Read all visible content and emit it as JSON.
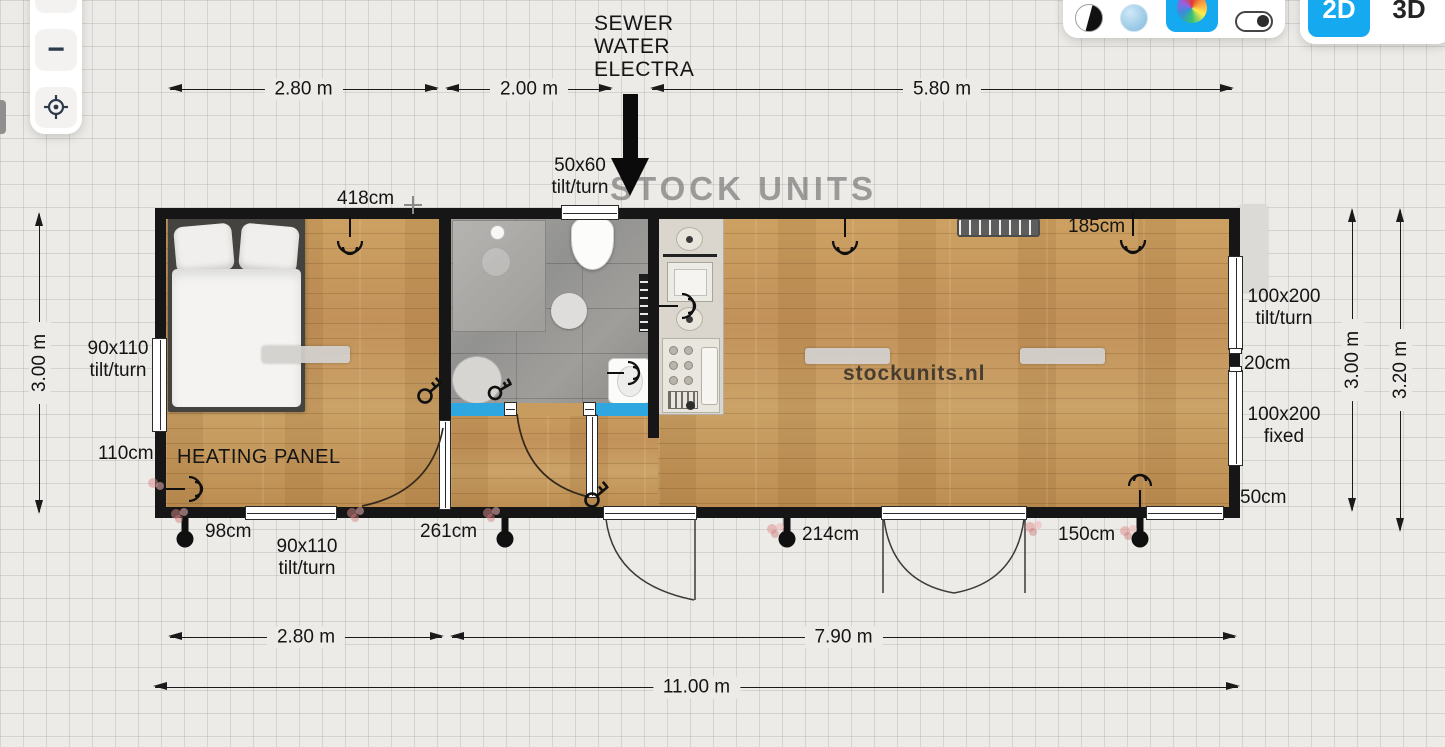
{
  "toolbar": {
    "zoom_in": "+",
    "zoom_out": "−"
  },
  "view_switch": {
    "two_d": "2D",
    "three_d": "3D"
  },
  "plan": {
    "watermark_logo": "STOCK UNITS",
    "watermark_site": "stockunits.nl",
    "heating_panel": "HEATING PANEL",
    "utility_lines": [
      "SEWER",
      "WATER",
      "ELECTRA"
    ],
    "labels": {
      "win_top": [
        "50x60",
        "tilt/turn"
      ],
      "len_418": "418cm",
      "len_185": "185cm",
      "win_right_top": [
        "100x200",
        "tilt/turn"
      ],
      "gap_20": "20cm",
      "win_right_bottom": [
        "100x200",
        "fixed"
      ],
      "len_50": "50cm",
      "win_left": [
        "90x110",
        "tilt/turn"
      ],
      "len_110": "110cm",
      "len_98": "98cm",
      "win_bottom": [
        "90x110",
        "tilt/turn"
      ],
      "len_261": "261cm",
      "len_214": "214cm",
      "len_150": "150cm"
    },
    "dims": {
      "top": [
        "2.80 m",
        "2.00 m",
        "5.80 m"
      ],
      "bottom_left": "2.80 m",
      "bottom_right": "7.90 m",
      "overall": "11.00 m",
      "left": "3.00 m",
      "right_inner": "3.00 m",
      "right_outer": "3.20 m"
    }
  }
}
